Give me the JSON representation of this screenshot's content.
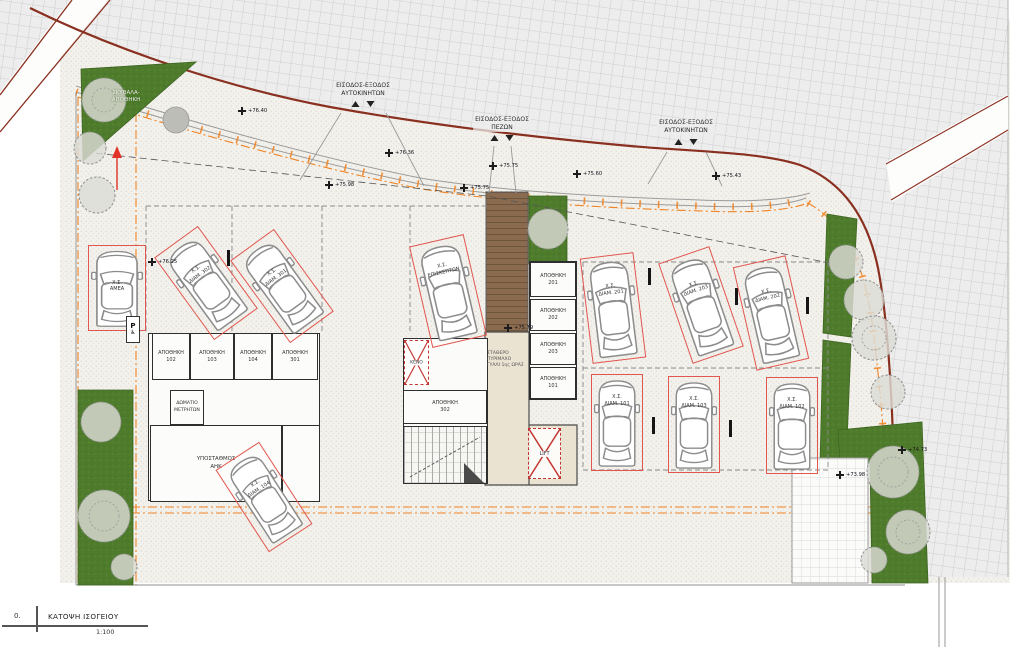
{
  "drawing": {
    "index": "0.",
    "title": "ΚΑΤΟΨΗ ΙΣΟΓΕΙΟΥ",
    "scale": "1:100"
  },
  "entrances": [
    {
      "line1": "ΕΙΣΟΔΟΣ-ΕΞΟΔΟΣ",
      "line2": "ΑΥΤΟΚΙΝΗΤΩΝ"
    },
    {
      "line1": "ΕΙΣΟΔΟΣ-ΕΞΟΔΟΣ",
      "line2": "ΠΕΖΩΝ"
    },
    {
      "line1": "ΕΙΣΟΔΟΣ-ΕΞΟΔΟΣ",
      "line2": "ΑΥΤΟΚΙΝΗΤΩΝ"
    }
  ],
  "garbage": {
    "line1": "ΣΚΥΒΑΛΑ-",
    "line2": "ΑΠΟΘΗΚΗ"
  },
  "rooms": {
    "meter_line1": "ΔΩΜΑΤΙΟ",
    "meter_line2": "ΜΕΤΡΗΤΩΝ",
    "substation_line1": "ΥΠΟΣΤΑΘΜΟΣ",
    "substation_line2": "ΑΗΚ",
    "void_label": "ΚΕΝΟ",
    "lift_label": "LIFT",
    "fire_glass_line1": "ΣΤΑΘΕΡΟ",
    "fire_glass_line2": "ΠΥΡΙΜΑΧΟ",
    "fire_glass_line3": "ΓΥΑΛΙ 1ης ΩΡΑΣ"
  },
  "storages": [
    {
      "name": "ΑΠΟΘΗΚΗ",
      "num": "102"
    },
    {
      "name": "ΑΠΟΘΗΚΗ",
      "num": "103"
    },
    {
      "name": "ΑΠΟΘΗΚΗ",
      "num": "104"
    },
    {
      "name": "ΑΠΟΘΗΚΗ",
      "num": "301"
    },
    {
      "name": "ΑΠΟΘΗΚΗ",
      "num": "201"
    },
    {
      "name": "ΑΠΟΘΗΚΗ",
      "num": "202"
    },
    {
      "name": "ΑΠΟΘΗΚΗ",
      "num": "203"
    },
    {
      "name": "ΑΠΟΘΗΚΗ",
      "num": "101"
    },
    {
      "name": "ΑΠΟΘΗΚΗ",
      "num": "302"
    }
  ],
  "parking": [
    {
      "type": "Χ.Σ.",
      "unit": "ΑΜΕΑ"
    },
    {
      "type": "Χ.Σ.",
      "unit": "ΔΙΑΜ. 302"
    },
    {
      "type": "Χ.Σ.",
      "unit": "ΔΙΑΜ. 301"
    },
    {
      "type": "Χ.Σ.",
      "unit": "ΕΠΙΣΚΕΠΤΩΝ"
    },
    {
      "type": "Χ.Σ.",
      "unit": "ΔΙΑΜ. 104"
    },
    {
      "type": "Χ.Σ.",
      "unit": "ΔΙΑΜ. 201"
    },
    {
      "type": "Χ.Σ.",
      "unit": "ΔΙΑΜ. 203"
    },
    {
      "type": "Χ.Σ.",
      "unit": "ΔΙΑΜ. 202"
    },
    {
      "type": "Χ.Σ.",
      "unit": "ΔΙΑΜ. 101"
    },
    {
      "type": "Χ.Σ.",
      "unit": "ΔΙΑΜ. 103"
    },
    {
      "type": "Χ.Σ.",
      "unit": "ΔΙΑΜ. 102"
    }
  ],
  "levels": [
    {
      "v": "+76.40"
    },
    {
      "v": "+76.36"
    },
    {
      "v": "+75.98"
    },
    {
      "v": "+75.75"
    },
    {
      "v": "+75.75"
    },
    {
      "v": "+75.60"
    },
    {
      "v": "+75.43"
    },
    {
      "v": "+75.79"
    },
    {
      "v": "+76.25"
    },
    {
      "v": "+74.73"
    },
    {
      "v": "+73.98"
    }
  ],
  "signs": {
    "accessible_parking": "P",
    "wheelchair": "♿"
  },
  "colors": {
    "road_edge": "#8a3020",
    "plot_boundary_orange": "#f08424",
    "parking_outline_red": "#e2564f",
    "landscape_green": "#4e7c2c",
    "deck_brown": "#8b6b4f",
    "lobby_beige": "#ebe3d2"
  }
}
